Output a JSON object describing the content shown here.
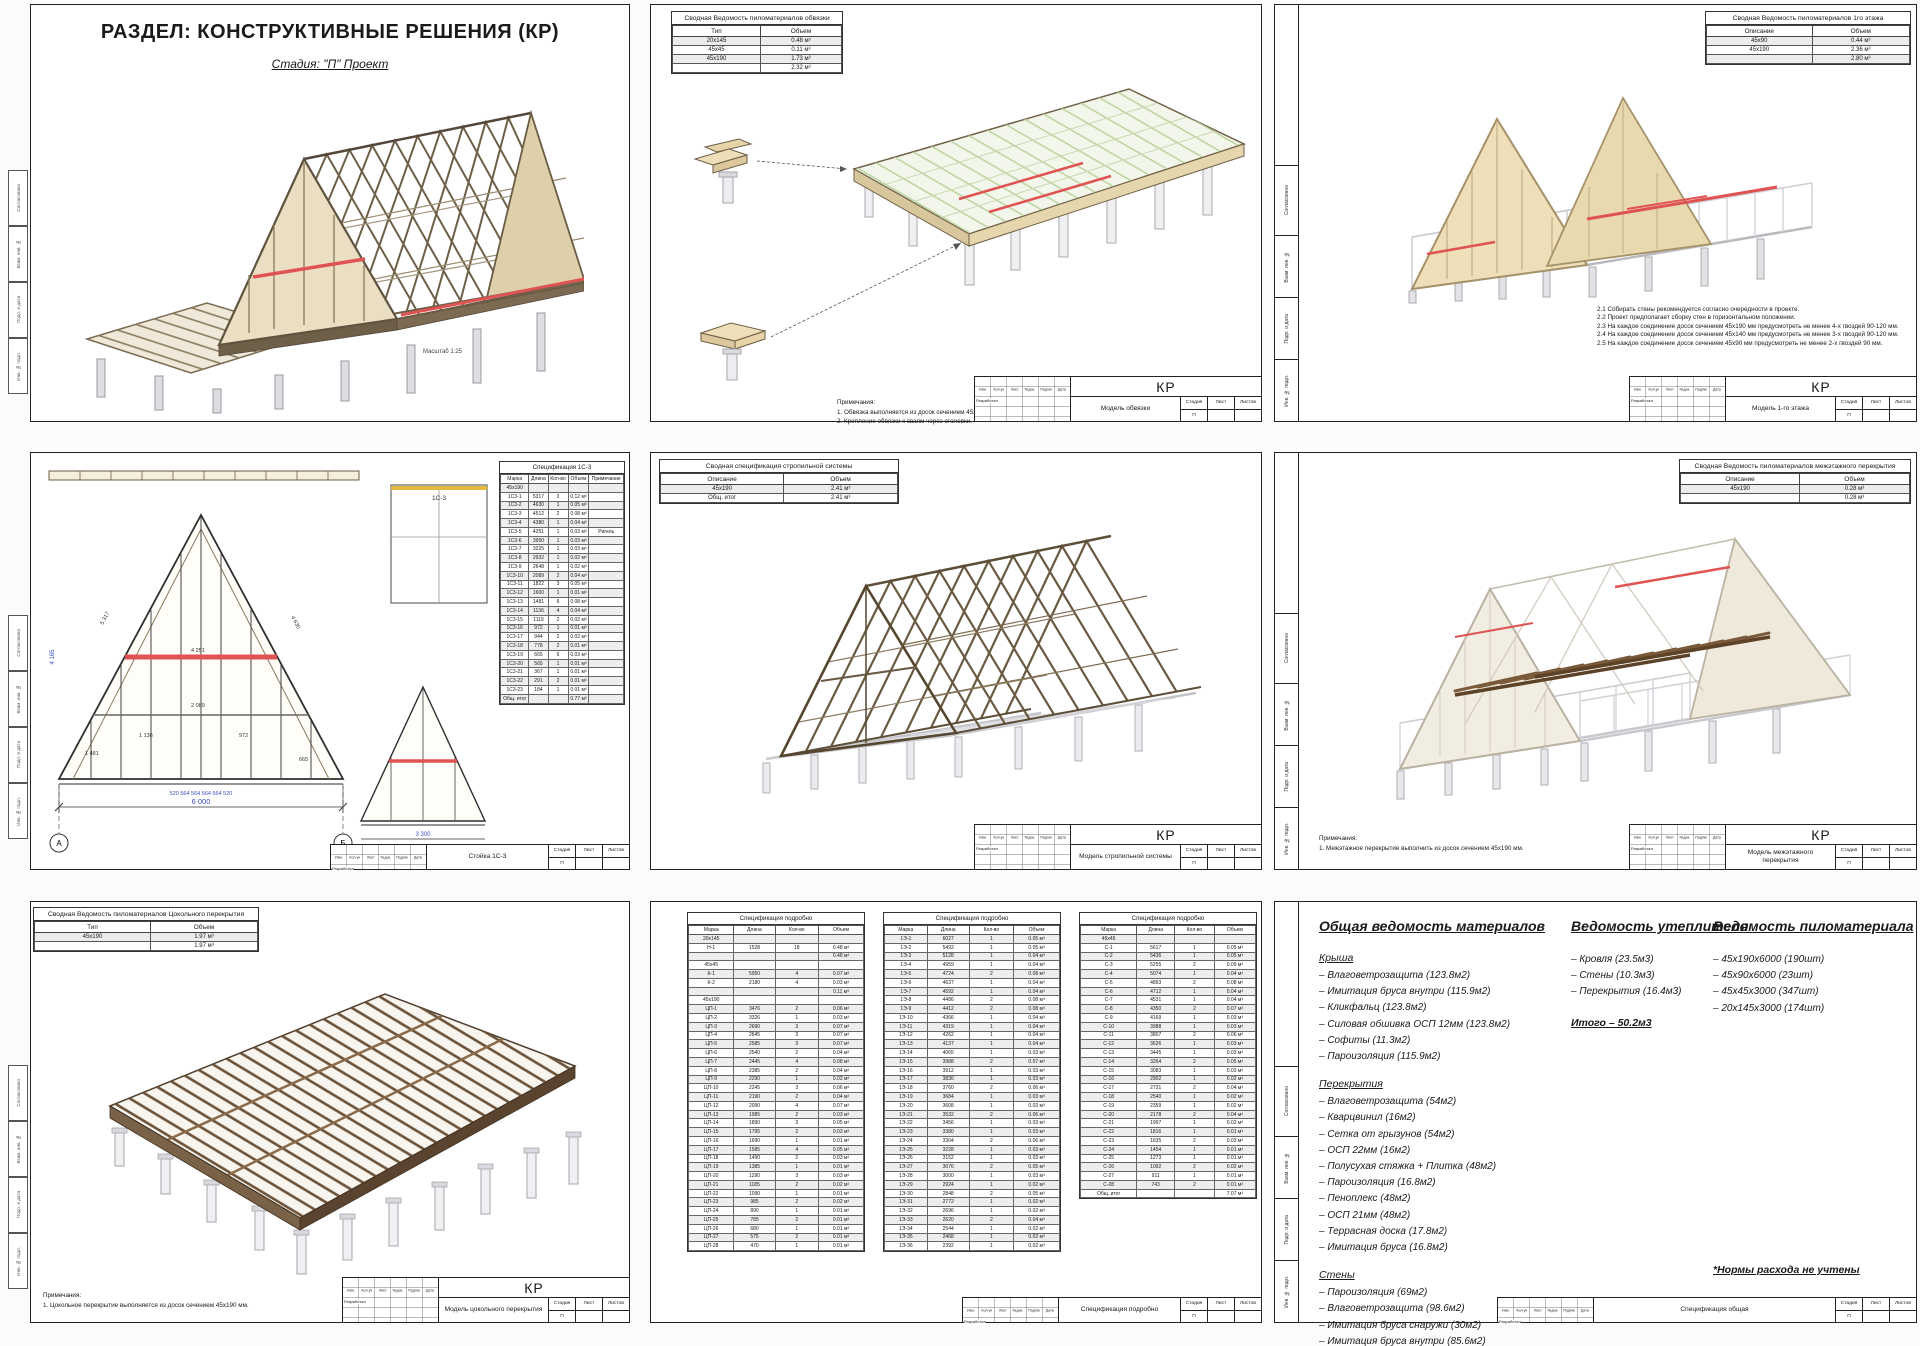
{
  "colors": {
    "accent_red": "#e05353",
    "wood_tan": "#eadfc2",
    "wood_brown": "#6e6048",
    "frame_gray": "#c9c9cf",
    "pile_gray": "#e3e3e7",
    "osb_green": "#b8d09a",
    "dim_blue": "#3a50c0"
  },
  "stamp_common": {
    "cols": [
      "Изм.",
      "Кол.уч",
      "Лист",
      "№док.",
      "Подпись",
      "Дата"
    ],
    "developer": "Разработал",
    "stage_label": "Стадия",
    "sheet_label": "Лист",
    "sheets_label": "Листов",
    "stage": "П",
    "sheet_no": "",
    "sheets_no": ""
  },
  "side_strip": {
    "labels": [
      "Согласовано",
      "Взам. инв. №",
      "Подп. и дата",
      "Инв. № подл."
    ]
  },
  "sheet1": {
    "title": "РАЗДЕЛ: КОНСТРУКТИВНЫЕ РЕШЕНИЯ (КР)",
    "subtitle": "Стадия: \"П\" Проект",
    "scale_note": "Масштаб 1:25"
  },
  "sheet2": {
    "table": {
      "title": "Сводная Ведомость пиломатериалов обвязки",
      "cols": [
        "Тип",
        "Объем"
      ],
      "rows": [
        [
          "20х145",
          "0.48 м³"
        ],
        [
          "45х45",
          "0.11 м³"
        ],
        [
          "45х190",
          "1.73 м³"
        ],
        [
          "",
          "2.32 м³"
        ]
      ]
    },
    "notes_title": "Примечания:",
    "notes": [
      "1. Обвязка выполняется из досок сечением 45х190 мм.",
      "2. Крепление обвязки к сваям через оголовки."
    ],
    "stamp_code": "КР",
    "stamp_title": "Модель обвязки"
  },
  "sheet3": {
    "table": {
      "title": "Сводная Ведомость пиломатериалов 1го этажа",
      "cols": [
        "Описание",
        "Объем"
      ],
      "rows": [
        [
          "45х90",
          "0.44 м³"
        ],
        [
          "45х190",
          "2.36 м³"
        ],
        [
          "",
          "2.80 м³"
        ]
      ]
    },
    "notes": [
      "2.1 Собирать стены рекомендуется согласно очередности в проекте.",
      "2.2 Проект предполагает сборку стен в горизонтальном положении.",
      "2.3 На каждое соединение досок сечением 45х190 мм предусмотреть не менее 4-х гвоздей 90-120 мм.",
      "2.4 На каждое соединение досок сечением 45х140 мм предусмотреть не менее 3-х гвоздей 90-120 мм.",
      "2.5 На каждое соединение досок сечением 45х90 мм предусмотреть не менее 2-х гвоздей 90 мм."
    ],
    "stamp_code": "КР",
    "stamp_title": "Модель 1-го этажа"
  },
  "sheet4": {
    "spec": {
      "title": "Спецификация 1С-3",
      "cols": [
        "Марка",
        "Длина",
        "Кол-во",
        "Объем",
        "Примечание"
      ],
      "rows": [
        [
          "45х190",
          "",
          "",
          "",
          ""
        ],
        [
          "1С3-1",
          "5317",
          "2",
          "0.12 м³",
          ""
        ],
        [
          "1С3-2",
          "4630",
          "1",
          "0.05 м³",
          ""
        ],
        [
          "1С3-3",
          "4512",
          "2",
          "0.08 м³",
          ""
        ],
        [
          "1С3-4",
          "4380",
          "1",
          "0.04 м³",
          ""
        ],
        [
          "1С3-5",
          "4251",
          "1",
          "0.03 м³",
          "Ригель"
        ],
        [
          "1С3-6",
          "3950",
          "1",
          "0.03 м³",
          ""
        ],
        [
          "1С3-7",
          "3225",
          "1",
          "0.03 м³",
          ""
        ],
        [
          "1С3-8",
          "2932",
          "1",
          "0.02 м³",
          ""
        ],
        [
          "1С3-9",
          "2648",
          "1",
          "0.02 м³",
          ""
        ],
        [
          "1С3-10",
          "2089",
          "2",
          "0.04 м³",
          ""
        ],
        [
          "1С3-11",
          "1822",
          "3",
          "0.05 м³",
          ""
        ],
        [
          "1С3-12",
          "1600",
          "1",
          "0.01 м³",
          ""
        ],
        [
          "1С3-13",
          "1481",
          "6",
          "0.08 м³",
          ""
        ],
        [
          "1С3-14",
          "1136",
          "4",
          "0.04 м³",
          ""
        ],
        [
          "1С3-15",
          "1119",
          "2",
          "0.02 м³",
          ""
        ],
        [
          "1С3-16",
          "972",
          "1",
          "0.01 м³",
          ""
        ],
        [
          "1С3-17",
          "944",
          "2",
          "0.02 м³",
          ""
        ],
        [
          "1С3-18",
          "778",
          "2",
          "0.01 м³",
          ""
        ],
        [
          "1С3-19",
          "665",
          "6",
          "0.03 м³",
          ""
        ],
        [
          "1С3-20",
          "565",
          "1",
          "0.01 м³",
          ""
        ],
        [
          "1С3-21",
          "367",
          "1",
          "0.01 м³",
          ""
        ],
        [
          "1С3-22",
          "291",
          "2",
          "0.01 м³",
          ""
        ],
        [
          "1С3-23",
          "184",
          "1",
          "0.01 м³",
          ""
        ],
        [
          "Общ. итог",
          "",
          "",
          "0.77 м³",
          ""
        ]
      ]
    },
    "plan_label": "1С-3",
    "dim_total": "6 000",
    "vert_dim": "4 165",
    "small_dim": "3 300",
    "base_dims": "520    564    564    564    564    520",
    "axis_left": "А",
    "axis_right": "Б",
    "member_dims": [
      "5 317",
      "4 630",
      "4 251",
      "2 089",
      "1 481",
      "1 136",
      "972",
      "665"
    ],
    "stamp_title": "Стойка 1С-3"
  },
  "sheet5": {
    "table": {
      "title": "Сводная спецификация стропильной системы",
      "cols": [
        "Описание",
        "Объем"
      ],
      "rows": [
        [
          "45х190",
          "2.41 м³"
        ],
        [
          "Общ. итог",
          "2.41 м³"
        ]
      ]
    },
    "stamp_code": "КР",
    "stamp_title": "Модель стропильной системы"
  },
  "sheet6": {
    "table": {
      "title": "Сводная Ведомость пиломатериалов межэтажного перекрытия",
      "cols": [
        "Описание",
        "Объем"
      ],
      "rows": [
        [
          "45х190",
          "0.28 м³"
        ],
        [
          "",
          "0.28 м³"
        ]
      ]
    },
    "notes_title": "Примечания:",
    "notes": [
      "1. Межэтажное перекрытие выполнить из досок сечением 45х190 мм."
    ],
    "stamp_code": "КР",
    "stamp_title": "Модель межэтажного перекрытия"
  },
  "sheet7": {
    "table": {
      "title": "Сводная Ведомость пиломатериалов Цокольного перекрытия",
      "cols": [
        "Тип",
        "Объем"
      ],
      "rows": [
        [
          "45х190",
          "1.97 м³"
        ],
        [
          "",
          "1.97 м³"
        ]
      ]
    },
    "notes_title": "Примечания:",
    "notes": [
      "1. Цокольное перекрытие выполняется из досок сечением 45х190 мм."
    ],
    "stamp_code": "КР",
    "stamp_title": "Модель цокольного перекрытия"
  },
  "sheet8": {
    "cols": [
      "Марка",
      "Длина",
      "Кол-во",
      "Объем"
    ],
    "tables": [
      {
        "title": "Спецификация подробно",
        "rows": [
          [
            "20х145",
            "",
            "",
            ""
          ],
          [
            "Н-1",
            "1528",
            "18",
            "0.48 м³"
          ],
          [
            "",
            "",
            "",
            "0.48 м³"
          ],
          [
            "45х45",
            "",
            "",
            ""
          ],
          [
            "К-1",
            "5950",
            "4",
            "0.07 м³"
          ],
          [
            "К-2",
            "2180",
            "4",
            "0.03 м³"
          ],
          [
            "",
            "",
            "",
            "0.11 м³"
          ],
          [
            "45х190",
            "",
            "",
            ""
          ],
          [
            "ЦП-1",
            "3476",
            "2",
            "0.06 м³"
          ],
          [
            "ЦП-2",
            "3326",
            "1",
            "0.03 м³"
          ],
          [
            "ЦП-3",
            "2690",
            "3",
            "0.07 м³"
          ],
          [
            "ЦП-4",
            "2645",
            "3",
            "0.07 м³"
          ],
          [
            "ЦП-5",
            "2585",
            "3",
            "0.07 м³"
          ],
          [
            "ЦП-6",
            "2540",
            "2",
            "0.04 м³"
          ],
          [
            "ЦП-7",
            "2445",
            "4",
            "0.08 м³"
          ],
          [
            "ЦП-8",
            "2385",
            "2",
            "0.04 м³"
          ],
          [
            "ЦП-9",
            "2290",
            "1",
            "0.02 м³"
          ],
          [
            "ЦП-10",
            "2245",
            "3",
            "0.06 м³"
          ],
          [
            "ЦП-11",
            "2190",
            "2",
            "0.04 м³"
          ],
          [
            "ЦП-12",
            "2090",
            "4",
            "0.07 м³"
          ],
          [
            "ЦП-13",
            "1985",
            "2",
            "0.03 м³"
          ],
          [
            "ЦП-14",
            "1890",
            "3",
            "0.05 м³"
          ],
          [
            "ЦП-15",
            "1795",
            "2",
            "0.03 м³"
          ],
          [
            "ЦП-16",
            "1690",
            "1",
            "0.01 м³"
          ],
          [
            "ЦП-17",
            "1585",
            "4",
            "0.05 м³"
          ],
          [
            "ЦП-18",
            "1490",
            "2",
            "0.03 м³"
          ],
          [
            "ЦП-19",
            "1385",
            "1",
            "0.01 м³"
          ],
          [
            "ЦП-20",
            "1290",
            "3",
            "0.03 м³"
          ],
          [
            "ЦП-21",
            "1185",
            "2",
            "0.02 м³"
          ],
          [
            "ЦП-22",
            "1090",
            "1",
            "0.01 м³"
          ],
          [
            "ЦП-23",
            "985",
            "2",
            "0.02 м³"
          ],
          [
            "ЦП-24",
            "890",
            "1",
            "0.01 м³"
          ],
          [
            "ЦП-25",
            "785",
            "2",
            "0.01 м³"
          ],
          [
            "ЦП-26",
            "680",
            "1",
            "0.01 м³"
          ],
          [
            "ЦП-27",
            "575",
            "2",
            "0.01 м³"
          ],
          [
            "ЦП-28",
            "470",
            "1",
            "0.01 м³"
          ]
        ]
      },
      {
        "title": "Спецификация подробно",
        "rows": [
          [
            "1Э-1",
            "6027",
            "1",
            "0.05 м³"
          ],
          [
            "1Э-2",
            "5492",
            "1",
            "0.05 м³"
          ],
          [
            "1Э-3",
            "5128",
            "1",
            "0.04 м³"
          ],
          [
            "1Э-4",
            "4959",
            "1",
            "0.04 м³"
          ],
          [
            "1Э-5",
            "4724",
            "2",
            "0.08 м³"
          ],
          [
            "1Э-6",
            "4637",
            "1",
            "0.04 м³"
          ],
          [
            "1Э-7",
            "4592",
            "1",
            "0.04 м³"
          ],
          [
            "1Э-8",
            "4486",
            "2",
            "0.08 м³"
          ],
          [
            "1Э-9",
            "4412",
            "2",
            "0.08 м³"
          ],
          [
            "1Э-10",
            "4366",
            "1",
            "0.04 м³"
          ],
          [
            "1Э-11",
            "4319",
            "1",
            "0.04 м³"
          ],
          [
            "1Э-12",
            "4262",
            "1",
            "0.04 м³"
          ],
          [
            "1Э-13",
            "4137",
            "1",
            "0.04 м³"
          ],
          [
            "1Э-14",
            "4065",
            "1",
            "0.03 м³"
          ],
          [
            "1Э-15",
            "3988",
            "2",
            "0.07 м³"
          ],
          [
            "1Э-16",
            "3912",
            "1",
            "0.03 м³"
          ],
          [
            "1Э-17",
            "3836",
            "1",
            "0.03 м³"
          ],
          [
            "1Э-18",
            "3760",
            "2",
            "0.06 м³"
          ],
          [
            "1Э-19",
            "3684",
            "1",
            "0.03 м³"
          ],
          [
            "1Э-20",
            "3608",
            "1",
            "0.03 м³"
          ],
          [
            "1Э-21",
            "3532",
            "2",
            "0.06 м³"
          ],
          [
            "1Э-22",
            "3456",
            "1",
            "0.03 м³"
          ],
          [
            "1Э-23",
            "3380",
            "1",
            "0.03 м³"
          ],
          [
            "1Э-24",
            "3304",
            "2",
            "0.06 м³"
          ],
          [
            "1Э-25",
            "3228",
            "1",
            "0.03 м³"
          ],
          [
            "1Э-26",
            "3152",
            "1",
            "0.03 м³"
          ],
          [
            "1Э-27",
            "3076",
            "2",
            "0.05 м³"
          ],
          [
            "1Э-28",
            "3000",
            "1",
            "0.03 м³"
          ],
          [
            "1Э-29",
            "2924",
            "1",
            "0.02 м³"
          ],
          [
            "1Э-30",
            "2848",
            "2",
            "0.05 м³"
          ],
          [
            "1Э-31",
            "2772",
            "1",
            "0.02 м³"
          ],
          [
            "1Э-32",
            "2696",
            "1",
            "0.02 м³"
          ],
          [
            "1Э-33",
            "2620",
            "2",
            "0.04 м³"
          ],
          [
            "1Э-34",
            "2544",
            "1",
            "0.02 м³"
          ],
          [
            "1Э-35",
            "2468",
            "1",
            "0.02 м³"
          ],
          [
            "1Э-36",
            "2392",
            "1",
            "0.02 м³"
          ]
        ]
      },
      {
        "title": "Спецификация подробно",
        "rows": [
          [
            "45х45",
            "",
            "",
            ""
          ],
          [
            "С-1",
            "5617",
            "1",
            "0.05 м³"
          ],
          [
            "С-2",
            "5436",
            "1",
            "0.05 м³"
          ],
          [
            "С-3",
            "5255",
            "2",
            "0.09 м³"
          ],
          [
            "С-4",
            "5074",
            "1",
            "0.04 м³"
          ],
          [
            "С-5",
            "4893",
            "2",
            "0.08 м³"
          ],
          [
            "С-6",
            "4712",
            "1",
            "0.04 м³"
          ],
          [
            "С-7",
            "4531",
            "1",
            "0.04 м³"
          ],
          [
            "С-8",
            "4350",
            "2",
            "0.07 м³"
          ],
          [
            "С-9",
            "4169",
            "1",
            "0.03 м³"
          ],
          [
            "С-10",
            "3988",
            "1",
            "0.03 м³"
          ],
          [
            "С-11",
            "3807",
            "2",
            "0.06 м³"
          ],
          [
            "С-12",
            "3626",
            "1",
            "0.03 м³"
          ],
          [
            "С-13",
            "3445",
            "1",
            "0.03 м³"
          ],
          [
            "С-14",
            "3264",
            "2",
            "0.05 м³"
          ],
          [
            "С-15",
            "3083",
            "1",
            "0.03 м³"
          ],
          [
            "С-16",
            "2902",
            "1",
            "0.02 м³"
          ],
          [
            "С-17",
            "2721",
            "2",
            "0.04 м³"
          ],
          [
            "С-18",
            "2540",
            "1",
            "0.02 м³"
          ],
          [
            "С-19",
            "2359",
            "1",
            "0.02 м³"
          ],
          [
            "С-20",
            "2178",
            "2",
            "0.04 м³"
          ],
          [
            "С-21",
            "1997",
            "1",
            "0.02 м³"
          ],
          [
            "С-22",
            "1816",
            "1",
            "0.01 м³"
          ],
          [
            "С-23",
            "1635",
            "2",
            "0.03 м³"
          ],
          [
            "С-24",
            "1454",
            "1",
            "0.01 м³"
          ],
          [
            "С-25",
            "1273",
            "1",
            "0.01 м³"
          ],
          [
            "С-26",
            "1092",
            "2",
            "0.02 м³"
          ],
          [
            "С-27",
            "911",
            "1",
            "0.01 м³"
          ],
          [
            "С-28",
            "743",
            "2",
            "0.01 м³"
          ],
          [
            "Общ. итог",
            "",
            "",
            "7.07 м³"
          ]
        ]
      }
    ],
    "stamp_title": "Спецификация подробно"
  },
  "sheet9": {
    "col1_title": "Общая ведомость материалов",
    "roof_title": "Крыша",
    "roof_items": [
      "– Влаговетрозащита (123.8м2)",
      "– Имитация бруса внутри (115.9м2)",
      "– Кликфальц (123.8м2)",
      "– Силовая обшивка ОСП 12мм (123.8м2)",
      "– Софиты (11.3м2)",
      "– Пароизоляция (115.9м2)"
    ],
    "floor_title": "Перекрытия",
    "floor_items": [
      "– Влаговетрозащита (54м2)",
      "– Кварцвинил (16м2)",
      "– Сетка от грызунов (54м2)",
      "– ОСП 22мм (16м2)",
      "– Полусухая стяжка + Плитка (48м2)",
      "– Пароизоляция (16.8м2)",
      "– Пеноплекс (48м2)",
      "– ОСП 21мм (48м2)",
      "– Террасная доска (17.8м2)",
      "– Имитация бруса (16.8м2)"
    ],
    "wall_title": "Стены",
    "wall_items": [
      "– Пароизоляция (69м2)",
      "– Влаговетрозащита (98.6м2)",
      "– Имитация бруса снаружи (30м2)",
      "– Имитация бруса внутри (85.6м2)",
      "– Силовая обшивка ОСП 12мм (61.2м2)"
    ],
    "col2_title": "Ведомость утеплителя",
    "insulation_items": [
      "– Кровля (23.5м3)",
      "– Стены (10.3м3)",
      "– Перекрытия (16.4м3)"
    ],
    "insulation_total": "Итого – 50.2м3",
    "col3_title": "Ведомость пиломатериала",
    "lumber_items": [
      "– 45х190х6000 (190шт)",
      "– 45х90х6000 (23шт)",
      "– 45х45х3000 (347шт)",
      "– 20х145х3000 (174шт)"
    ],
    "footnote": "*Нормы расхода не учтены",
    "stamp_title": "Спецификация общая"
  }
}
